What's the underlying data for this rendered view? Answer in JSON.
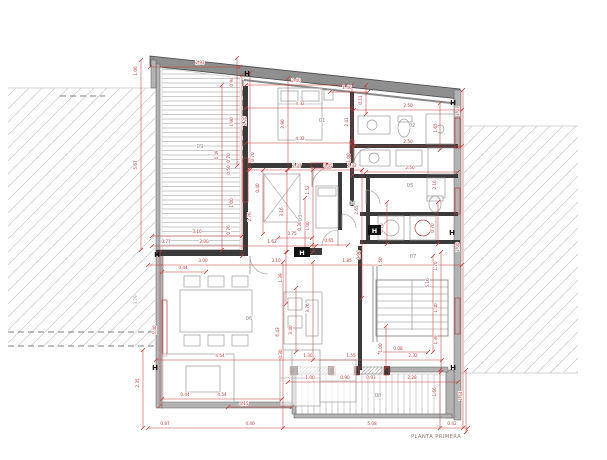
{
  "title": "PLANTA PRIMERA",
  "colors": {
    "dim_red": "#c23b3b",
    "dim_gray": "#9a9a9a",
    "wall_dark": "#3a3a3a",
    "wall_gray": "#b3b3b3",
    "roof_fill": "#8f8f8f",
    "roof_edge": "#4a4a4a",
    "furniture": "#9a9a9a",
    "room_label": "#909090",
    "hatch": "#cfcfcf",
    "marker": "#111111",
    "title_color": "#a07070"
  },
  "rooms": [
    {
      "id": "01",
      "x": 322,
      "y": 122,
      "rot": 0
    },
    {
      "id": "02",
      "x": 412,
      "y": 127,
      "rot": 0
    },
    {
      "id": "03",
      "x": 302,
      "y": 218,
      "rot": 1
    },
    {
      "id": "04",
      "x": 352,
      "y": 205,
      "rot": 0
    },
    {
      "id": "05",
      "x": 410,
      "y": 187,
      "rot": 0
    },
    {
      "id": "06",
      "x": 249,
      "y": 320,
      "rot": 0
    },
    {
      "id": "07",
      "x": 413,
      "y": 258,
      "rot": 0
    },
    {
      "id": "08",
      "x": 378,
      "y": 397,
      "rot": 0
    },
    {
      "id": "09",
      "x": 200,
      "y": 148,
      "rot": 0
    }
  ],
  "dim_labels": [
    {
      "t": "1.06",
      "x": 137,
      "y": 71,
      "v": 1
    },
    {
      "t": "2.93",
      "x": 200,
      "y": 64
    },
    {
      "t": "0.94",
      "x": 233,
      "y": 82,
      "v": 1
    },
    {
      "t": "5.67",
      "x": 137,
      "y": 165,
      "v": 1
    },
    {
      "t": "6.49",
      "x": 218,
      "y": 155,
      "v": 1
    },
    {
      "t": "1.90",
      "x": 233,
      "y": 122,
      "v": 1
    },
    {
      "t": "2.20",
      "x": 246,
      "y": 121,
      "v": 1
    },
    {
      "t": "2.90",
      "x": 284,
      "y": 124,
      "v": 1
    },
    {
      "t": "2.40",
      "x": 296,
      "y": 82
    },
    {
      "t": "1.46",
      "x": 347,
      "y": 89
    },
    {
      "t": "0.11",
      "x": 362,
      "y": 100,
      "v": 1
    },
    {
      "t": "4.32",
      "x": 300,
      "y": 105
    },
    {
      "t": "4.32",
      "x": 300,
      "y": 140
    },
    {
      "t": "2.41",
      "x": 348,
      "y": 122,
      "v": 1
    },
    {
      "t": "1.00",
      "x": 350,
      "y": 158,
      "v": 1
    },
    {
      "t": "2.50",
      "x": 408,
      "y": 107
    },
    {
      "t": "2.50",
      "x": 408,
      "y": 143
    },
    {
      "t": "2.50",
      "x": 410,
      "y": 169
    },
    {
      "t": "1.65",
      "x": 437,
      "y": 128,
      "v": 1
    },
    {
      "t": "1.01",
      "x": 459,
      "y": 111,
      "v": 1
    },
    {
      "t": "0.70",
      "x": 230,
      "y": 158,
      "v": 1
    },
    {
      "t": "0.50",
      "x": 230,
      "y": 170,
      "v": 1
    },
    {
      "t": "0.70",
      "x": 254,
      "y": 157,
      "v": 1
    },
    {
      "t": "1.00",
      "x": 233,
      "y": 203,
      "v": 1
    },
    {
      "t": "0.76",
      "x": 230,
      "y": 230,
      "v": 1
    },
    {
      "t": "2.76",
      "x": 251,
      "y": 217,
      "v": 1
    },
    {
      "t": "0.40",
      "x": 259,
      "y": 188,
      "v": 1
    },
    {
      "t": "2.37",
      "x": 297,
      "y": 167
    },
    {
      "t": "0.45",
      "x": 328,
      "y": 167
    },
    {
      "t": "1.32",
      "x": 352,
      "y": 167
    },
    {
      "t": "1.52",
      "x": 309,
      "y": 190,
      "v": 1
    },
    {
      "t": "3.16",
      "x": 283,
      "y": 212,
      "v": 1
    },
    {
      "t": "0.30",
      "x": 301,
      "y": 226,
      "v": 1
    },
    {
      "t": "1.00",
      "x": 309,
      "y": 226,
      "v": 1
    },
    {
      "t": "2.65",
      "x": 358,
      "y": 210,
      "v": 1
    },
    {
      "t": "2.16",
      "x": 436,
      "y": 185,
      "v": 1
    },
    {
      "t": "0.70",
      "x": 383,
      "y": 228,
      "v": 1
    },
    {
      "t": "0.70",
      "x": 434,
      "y": 228,
      "v": 1
    },
    {
      "t": "0.75",
      "x": 292,
      "y": 235
    },
    {
      "t": "3.10",
      "x": 197,
      "y": 233
    },
    {
      "t": "0.77",
      "x": 166,
      "y": 243
    },
    {
      "t": "2.00",
      "x": 204,
      "y": 243
    },
    {
      "t": "1.62",
      "x": 272,
      "y": 243
    },
    {
      "t": "0.65",
      "x": 329,
      "y": 242
    },
    {
      "t": "3.00",
      "x": 203,
      "y": 262
    },
    {
      "t": "3.10",
      "x": 276,
      "y": 262
    },
    {
      "t": "1.85",
      "x": 347,
      "y": 262
    },
    {
      "t": "0.90",
      "x": 360,
      "y": 255,
      "v": 1
    },
    {
      "t": "0.44",
      "x": 183,
      "y": 269
    },
    {
      "t": "1.39",
      "x": 282,
      "y": 278,
      "v": 1
    },
    {
      "t": "1.50",
      "x": 382,
      "y": 262,
      "v": 1
    },
    {
      "t": "1.70",
      "x": 437,
      "y": 266,
      "v": 1
    },
    {
      "t": "5.16",
      "x": 429,
      "y": 283,
      "v": 1
    },
    {
      "t": "1.40",
      "x": 437,
      "y": 308,
      "v": 1
    },
    {
      "t": "1.39",
      "x": 437,
      "y": 340,
      "v": 1
    },
    {
      "t": "1.00",
      "x": 382,
      "y": 348,
      "v": 1
    },
    {
      "t": "0.08",
      "x": 398,
      "y": 350
    },
    {
      "t": "2.32",
      "x": 413,
      "y": 357
    },
    {
      "t": "1.30",
      "x": 308,
      "y": 357
    },
    {
      "t": "1.55",
      "x": 351,
      "y": 357
    },
    {
      "t": "4.54",
      "x": 220,
      "y": 357
    },
    {
      "t": "0.44",
      "x": 185,
      "y": 396
    },
    {
      "t": "4.54",
      "x": 222,
      "y": 396
    },
    {
      "t": "4.15",
      "x": 244,
      "y": 405
    },
    {
      "t": "1.00",
      "x": 310,
      "y": 379
    },
    {
      "t": "0.90",
      "x": 345,
      "y": 379
    },
    {
      "t": "0.93",
      "x": 371,
      "y": 379
    },
    {
      "t": "2.28",
      "x": 412,
      "y": 379
    },
    {
      "t": "1.00",
      "x": 459,
      "y": 247,
      "v": 1
    },
    {
      "t": "1.66",
      "x": 436,
      "y": 392,
      "v": 1
    },
    {
      "t": "1.64",
      "x": 462,
      "y": 396,
      "v": 1
    },
    {
      "t": "0.42",
      "x": 452,
      "y": 425
    },
    {
      "t": "0.87",
      "x": 165,
      "y": 425
    },
    {
      "t": "4.40",
      "x": 250,
      "y": 425
    },
    {
      "t": "5.08",
      "x": 372,
      "y": 425
    },
    {
      "t": "5.40",
      "x": 156,
      "y": 330,
      "v": 1
    },
    {
      "t": "3.79",
      "x": 137,
      "y": 300,
      "v": 1,
      "g": 1
    },
    {
      "t": "2.35",
      "x": 139,
      "y": 383,
      "v": 1
    },
    {
      "t": "6.43",
      "x": 279,
      "y": 332,
      "v": 1
    },
    {
      "t": "3.40",
      "x": 292,
      "y": 330,
      "v": 1
    },
    {
      "t": "3.76",
      "x": 309,
      "y": 308,
      "v": 1
    },
    {
      "t": "0.30",
      "x": 282,
      "y": 354,
      "v": 1
    }
  ],
  "red_lines": [
    [
      141,
      60,
      141,
      250
    ],
    [
      222,
      85,
      222,
      250
    ],
    [
      237,
      58,
      237,
      166
    ],
    [
      242,
      75,
      242,
      256
    ],
    [
      250,
      73,
      250,
      170
    ],
    [
      263,
      170,
      263,
      234
    ],
    [
      286,
      252,
      286,
      304
    ],
    [
      287,
      170,
      287,
      252
    ],
    [
      288,
      78,
      288,
      170
    ],
    [
      296,
      288,
      296,
      352
    ],
    [
      305,
      198,
      305,
      252
    ],
    [
      313,
      170,
      313,
      252
    ],
    [
      313,
      262,
      313,
      360
    ],
    [
      283,
      262,
      283,
      428
    ],
    [
      352,
      85,
      352,
      176
    ],
    [
      362,
      170,
      362,
      298
    ],
    [
      366,
      85,
      366,
      114
    ],
    [
      386,
      326,
      386,
      368
    ],
    [
      387,
      202,
      387,
      244
    ],
    [
      433,
      256,
      433,
      352
    ],
    [
      438,
      202,
      438,
      244
    ],
    [
      440,
      103,
      440,
      150
    ],
    [
      441,
      252,
      441,
      372
    ],
    [
      463,
      90,
      463,
      428
    ],
    [
      160,
      252,
      160,
      406
    ],
    [
      143,
      350,
      143,
      428
    ],
    [
      440,
      370,
      440,
      428
    ],
    [
      466,
      370,
      466,
      432
    ],
    [
      150,
      67,
      240,
      67
    ],
    [
      246,
      85,
      346,
      85
    ],
    [
      330,
      92,
      368,
      92
    ],
    [
      246,
      108,
      352,
      108
    ],
    [
      246,
      143,
      352,
      143
    ],
    [
      354,
      110,
      462,
      110
    ],
    [
      354,
      146,
      462,
      146
    ],
    [
      366,
      172,
      458,
      172
    ],
    [
      248,
      170,
      362,
      170
    ],
    [
      278,
      238,
      312,
      238
    ],
    [
      152,
      236,
      242,
      236
    ],
    [
      152,
      246,
      316,
      246
    ],
    [
      312,
      245,
      348,
      245
    ],
    [
      148,
      265,
      462,
      265
    ],
    [
      162,
      272,
      206,
      272
    ],
    [
      156,
      360,
      442,
      360
    ],
    [
      162,
      399,
      282,
      399
    ],
    [
      228,
      407,
      292,
      407
    ],
    [
      288,
      382,
      458,
      382
    ],
    [
      148,
      428,
      468,
      428
    ],
    [
      380,
      352,
      428,
      352
    ]
  ],
  "red_rects": [
    [
      455,
      118,
      5,
      30
    ],
    [
      455,
      188,
      5,
      26
    ],
    [
      455,
      298,
      5,
      36
    ],
    [
      243,
      158,
      5,
      44
    ],
    [
      311,
      163,
      20,
      5
    ],
    [
      350,
      140,
      4,
      26
    ],
    [
      290,
      367,
      5,
      8
    ],
    [
      330,
      367,
      5,
      8
    ],
    [
      354,
      367,
      5,
      8
    ],
    [
      384,
      367,
      5,
      8
    ],
    [
      162,
      300,
      5,
      56
    ]
  ],
  "walls_dark": [
    [
      243,
      86,
      5,
      170
    ],
    [
      246,
      163,
      108,
      5
    ],
    [
      350,
      92,
      4,
      114
    ],
    [
      354,
      144,
      104,
      4
    ],
    [
      354,
      174,
      104,
      4
    ],
    [
      366,
      176,
      4,
      68
    ],
    [
      360,
      212,
      98,
      4
    ],
    [
      360,
      240,
      100,
      4
    ],
    [
      358,
      246,
      4,
      124
    ],
    [
      156,
      250,
      92,
      6
    ],
    [
      300,
      248,
      22,
      7
    ],
    [
      338,
      172,
      4,
      58
    ],
    [
      290,
      366,
      8,
      9
    ],
    [
      328,
      366,
      6,
      9
    ],
    [
      354,
      366,
      6,
      9
    ],
    [
      384,
      366,
      6,
      9
    ]
  ],
  "walls_gray": [
    [
      156,
      64,
      4,
      188
    ],
    [
      156,
      250,
      7,
      158
    ],
    [
      162,
      402,
      132,
      6
    ],
    [
      454,
      90,
      7,
      330
    ],
    [
      446,
      370,
      8,
      48
    ],
    [
      294,
      414,
      158,
      4
    ],
    [
      390,
      367,
      58,
      5
    ],
    [
      151,
      60,
      5,
      28
    ],
    [
      292,
      370,
      4,
      44
    ]
  ],
  "roof": {
    "poly": "150,56 460,89 460,99 150,66",
    "line": [
      244,
      80,
      460,
      104
    ]
  },
  "hatches": {
    "left": [
      8,
      88,
      147,
      258
    ],
    "right": [
      464,
      126,
      114,
      247
    ],
    "room09": "162,68 240,78 240,250 162,250",
    "terrace": [
      296,
      374,
      150,
      40
    ],
    "sills": [
      [
        296,
        367,
        32,
        7
      ],
      [
        356,
        367,
        26,
        7
      ]
    ]
  },
  "dashed_lines": [
    [
      8,
      332,
      156,
      332
    ],
    [
      8,
      346,
      160,
      346
    ],
    [
      243,
      80,
      243,
      162
    ],
    [
      60,
      96,
      105,
      96
    ]
  ],
  "furn_rects": [
    [
      278,
      88,
      44,
      52
    ],
    [
      281,
      91,
      17,
      10
    ],
    [
      302,
      91,
      17,
      10
    ],
    [
      324,
      90,
      9,
      10
    ],
    [
      264,
      174,
      36,
      48
    ],
    [
      316,
      186,
      22,
      42
    ],
    [
      318,
      188,
      18,
      8
    ],
    [
      180,
      290,
      72,
      42
    ],
    [
      184,
      276,
      16,
      11
    ],
    [
      208,
      276,
      16,
      11
    ],
    [
      232,
      276,
      16,
      11
    ],
    [
      184,
      335,
      16,
      11
    ],
    [
      208,
      335,
      16,
      11
    ],
    [
      232,
      335,
      16,
      11
    ],
    [
      162,
      354,
      72,
      48
    ],
    [
      186,
      366,
      34,
      26
    ],
    [
      280,
      350,
      40,
      56
    ],
    [
      320,
      360,
      36,
      42
    ],
    [
      284,
      292,
      38,
      52
    ],
    [
      288,
      298,
      14,
      12
    ],
    [
      288,
      316,
      14,
      12
    ],
    [
      306,
      300,
      12,
      36
    ],
    [
      358,
      116,
      32,
      18
    ],
    [
      398,
      116,
      14,
      6
    ],
    [
      426,
      114,
      28,
      30
    ],
    [
      360,
      150,
      30,
      16
    ],
    [
      396,
      150,
      26,
      16
    ],
    [
      428,
      148,
      26,
      26
    ],
    [
      427,
      178,
      18,
      20
    ],
    [
      427,
      196,
      16,
      5
    ],
    [
      378,
      216,
      26,
      24
    ],
    [
      410,
      216,
      26,
      24
    ]
  ],
  "furn_lines": [
    [
      278,
      104,
      322,
      104
    ],
    [
      264,
      174,
      300,
      222
    ],
    [
      300,
      174,
      264,
      222
    ],
    [
      280,
      378,
      320,
      378
    ],
    [
      320,
      381,
      356,
      381
    ],
    [
      292,
      350,
      292,
      406
    ]
  ],
  "furn_circles": [
    [
      372,
      125,
      5,
      0
    ],
    [
      440,
      129,
      4,
      0
    ],
    [
      374,
      158,
      5,
      0
    ],
    [
      391,
      228,
      8,
      0
    ],
    [
      423,
      228,
      8,
      1
    ]
  ],
  "furn_ellipses": [
    [
      404,
      128,
      6,
      9
    ],
    [
      435,
      204,
      6,
      8
    ]
  ],
  "arcs": [
    {
      "p": "M 312 187 A 20 20 0 0 1 332 167",
      "l": [
        312,
        167,
        312,
        187
      ]
    },
    {
      "p": "M 354 164 A 16 16 0 0 1 370 148",
      "l": [
        354,
        148,
        354,
        164
      ]
    },
    {
      "p": "M 322 246 A 16 16 0 0 1 338 230",
      "l": [
        338,
        230,
        338,
        246
      ]
    },
    {
      "p": "M 366 190 A 14 14 0 0 1 380 204",
      "l": [
        366,
        190,
        366,
        204
      ]
    },
    {
      "p": "M 250 256 A 18 18 0 0 0 268 274",
      "l": [
        250,
        256,
        250,
        274
      ]
    },
    {
      "p": "M 342 214 A 14 14 0 0 1 356 228",
      "l": [
        342,
        214,
        342,
        228
      ]
    }
  ],
  "stairs": {
    "x": 376,
    "y": 280,
    "w": 72,
    "h": 56,
    "steps": 8,
    "rail": [
      373,
      266,
      377,
      342
    ]
  },
  "h_markers": [
    [
      247,
      73
    ],
    [
      157,
      254
    ],
    [
      155,
      367
    ],
    [
      453,
      102
    ],
    [
      452,
      232
    ],
    [
      453,
      367
    ]
  ],
  "h_boxes": [
    [
      294,
      247,
      16,
      10
    ],
    [
      368,
      225,
      13,
      10
    ]
  ]
}
